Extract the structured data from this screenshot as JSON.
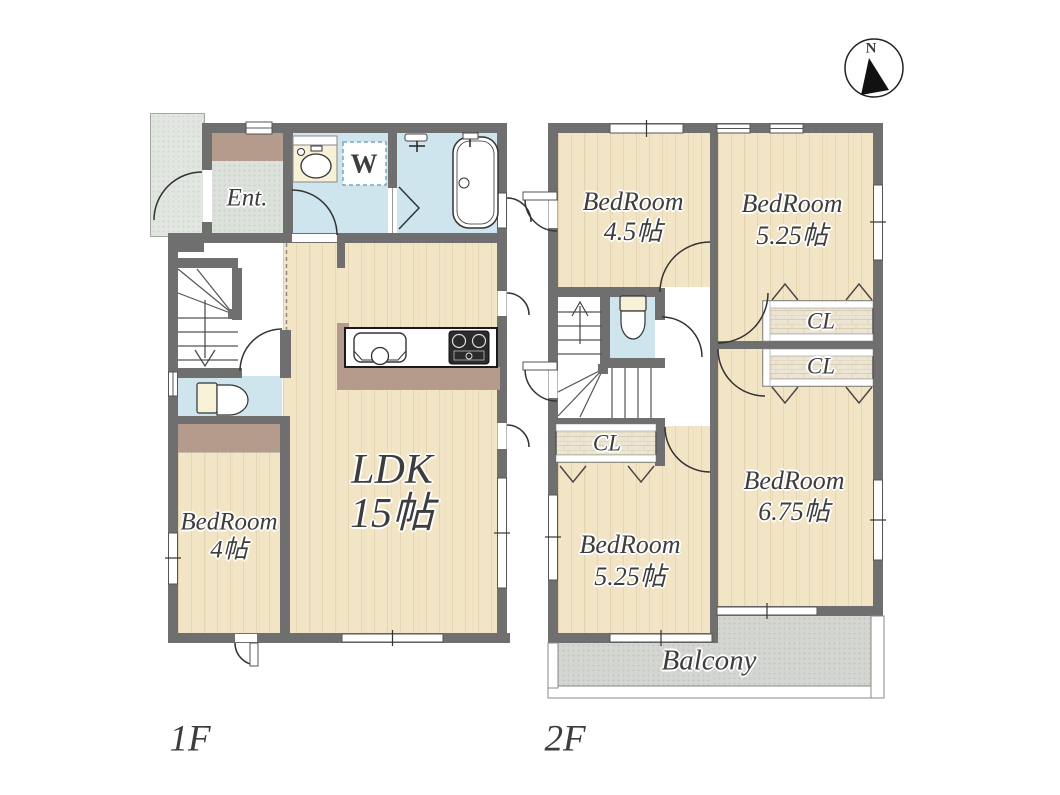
{
  "compass": {
    "north_label": "N"
  },
  "floors": {
    "f1": {
      "label": "1F",
      "rooms": {
        "entrance": {
          "label": "Ent."
        },
        "washing_machine": {
          "label": "W"
        },
        "ldk": {
          "name": "LDK",
          "size": "15帖"
        },
        "bedroom": {
          "name": "BedRoom",
          "size": "4帖"
        }
      }
    },
    "f2": {
      "label": "2F",
      "rooms": {
        "bedroom_45": {
          "name": "BedRoom",
          "size": "4.5帖"
        },
        "bedroom_525_north": {
          "name": "BedRoom",
          "size": "5.25帖"
        },
        "bedroom_525_south": {
          "name": "BedRoom",
          "size": "5.25帖"
        },
        "bedroom_675": {
          "name": "BedRoom",
          "size": "6.75帖"
        },
        "closet_north_upper": {
          "label": "CL"
        },
        "closet_north_lower": {
          "label": "CL"
        },
        "closet_west": {
          "label": "CL"
        },
        "balcony": {
          "label": "Balcony"
        }
      }
    }
  },
  "colors": {
    "wall": "#6f6f6f",
    "wood_floor": "#f2e5c6",
    "wet_room": "#cfe5ee",
    "entrance_floor": "#dce1dc",
    "step_brown": "#b59b8c",
    "balcony": "#d4d6d1",
    "closet_floor": "#ece5d3",
    "label_text": "#3d3d3d"
  }
}
